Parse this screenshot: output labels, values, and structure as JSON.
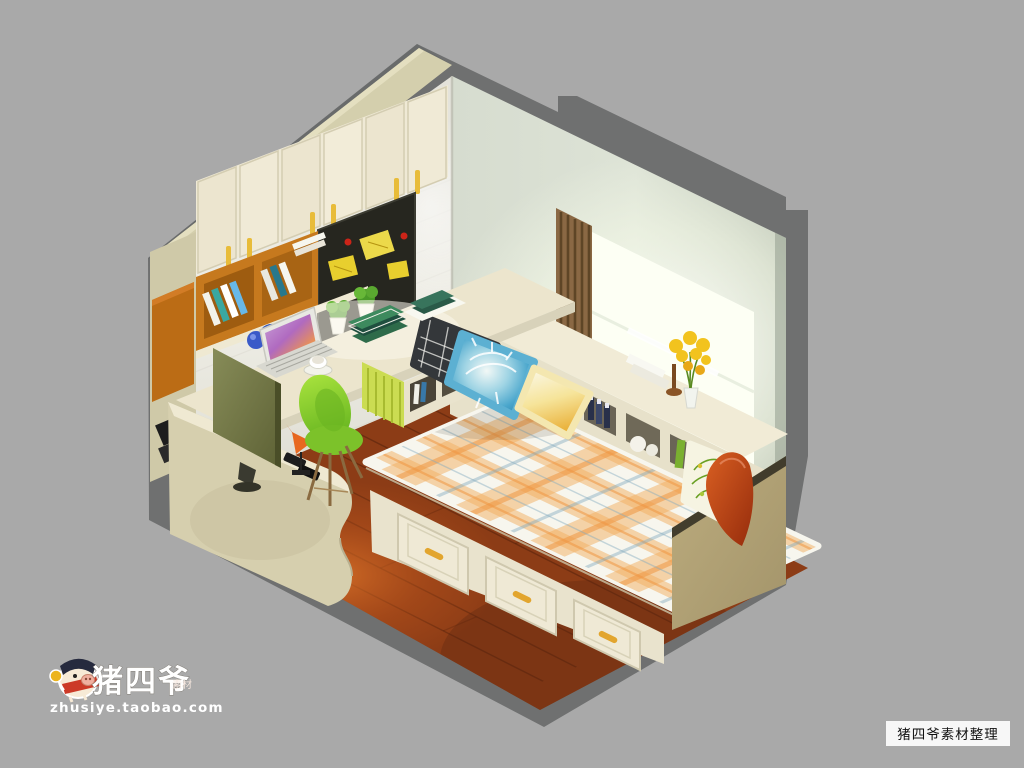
{
  "meta": {
    "type": "3d-isometric-interior-render",
    "description": "Cutaway isometric render of a small bedroom-study: tatami storage bed under a bay window, corner desk with monitor and laptop, wall cabinets, chalkboard and shelving",
    "view": "dollhouse cutaway, two walls and floor visible"
  },
  "watermarks": {
    "brand": "猪四爷",
    "brand_sub": "素材",
    "url": "zhusiye.taobao.com",
    "corner_tag": "猪四爷素材整理"
  },
  "palette": {
    "background": "#a9a9a9",
    "exterior_shell": "#6f7070",
    "wall_top_band": "#d4cfad",
    "left_wall": "#eceae2",
    "right_wall": "#ccd3c7",
    "window_glow": "#fcfff4",
    "curtain_brown": "#8a6844",
    "cabinet_cream": "#efe9d5",
    "handle_yellow": "#e8bc3a",
    "shelf_orange": "#c6791e",
    "blackboard": "#26261f",
    "sticky_note": "#e8cf2e",
    "desk_top": "#ece5cd",
    "monitor_olive": "#767b49",
    "chair_green": "#8bd02f",
    "floor_wood": "#8c3c16",
    "floor_glow": "#e06a24",
    "mattress_base": "#f7f6ee",
    "plaid_orange": "#f2ae60",
    "bed_base": "#e9e3cd",
    "bed_end_khaki": "#b3a477",
    "pillow_dark": "#34373a",
    "pillow_blue": "#3c9ec6",
    "pillow_yellow": "#f0c84e",
    "pillow_red": "#bf3f14",
    "flower_yellow": "#f2c31e"
  },
  "scene_objects": [
    "wall cabinets with yellow pulls",
    "chalkboard with sticky notes and magnets",
    "orange open shelf with books",
    "potted plants",
    "picture frame",
    "corner desk",
    "laptop with photo on screen",
    "blue desk lamp",
    "coffee cup and saucer",
    "stacked books",
    "flat monitor on low cabinet",
    "bird figurine",
    "green shell chair",
    "rounded-end low cabinet",
    "tatami bed with three storage drawers",
    "orange plaid mattress",
    "dark plaid pillow",
    "blue tie-dye pillow",
    "yellow gradient pillow",
    "leaf print pillow",
    "red pillow",
    "bay window with bright daylight",
    "brown striped curtain",
    "window bench desk with cubby storage",
    "yellow flowers in vase",
    "wooden plank floor"
  ]
}
